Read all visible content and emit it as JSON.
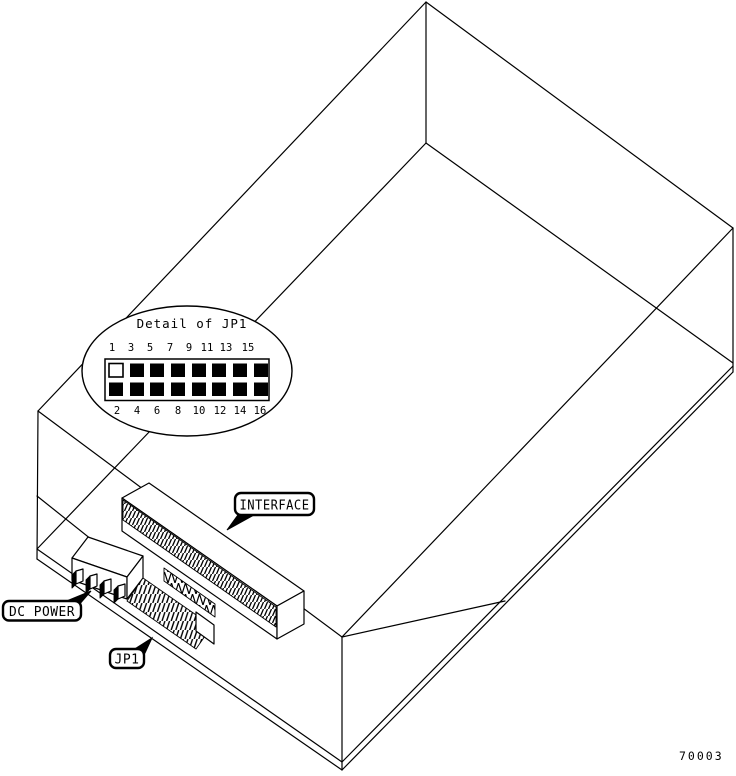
{
  "figure": {
    "number": "70003"
  },
  "detail_callout": {
    "title": "Detail of JP1",
    "top_pin_labels": [
      "1",
      "3",
      "5",
      "7",
      "9",
      "11",
      "13",
      "15"
    ],
    "bottom_pin_labels": [
      "2",
      "4",
      "6",
      "8",
      "10",
      "12",
      "14",
      "16"
    ],
    "pin1_state": "open",
    "other_pins_state": "jumpered"
  },
  "component_labels": {
    "interface": "INTERFACE",
    "dc_power": "DC POWER",
    "jp1": "JP1"
  },
  "colors": {
    "line": "#000000",
    "background": "#ffffff"
  }
}
